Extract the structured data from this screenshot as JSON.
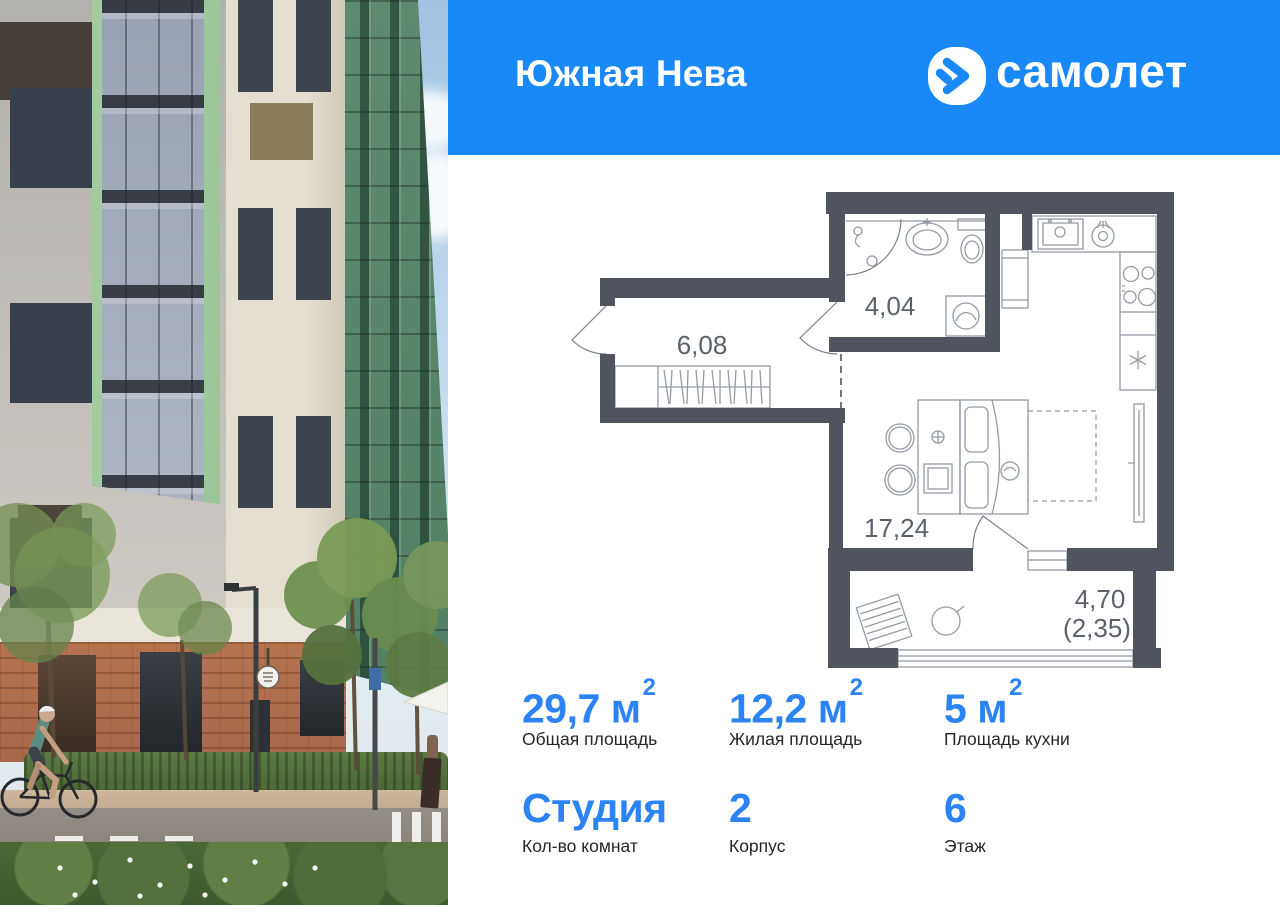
{
  "card": {
    "header": {
      "title": "Южная Нева",
      "brand": "самолет",
      "bg_color": "#1989FA"
    },
    "photo": {
      "description": "residential-building-street-view",
      "palette": {
        "sky": "#C6DCEF",
        "green_facade": "#A3CBA0",
        "brick": "#B5734F",
        "gray_facade": "#B3B1AD",
        "cream_facade": "#E4DFD1"
      }
    },
    "floor_plan": {
      "wall_color": "#50545E",
      "rooms": [
        {
          "id": "hallway",
          "area": "6,08"
        },
        {
          "id": "bathroom",
          "area": "4,04"
        },
        {
          "id": "living-room",
          "area": "17,24"
        },
        {
          "id": "balcony",
          "area": "4,70",
          "area_secondary": "(2,35)"
        }
      ]
    },
    "stats": {
      "accent_color": "#2B83F6",
      "areas": [
        {
          "value": "29,7",
          "unit": "м",
          "power": "2",
          "label": "Общая площадь"
        },
        {
          "value": "12,2",
          "unit": "м",
          "power": "2",
          "label": "Жилая площадь"
        },
        {
          "value": "5",
          "unit": "м",
          "power": "2",
          "label": "Площадь кухни"
        }
      ],
      "details": [
        {
          "value": "Студия",
          "label": "Кол-во комнат"
        },
        {
          "value": "2",
          "label": "Корпус"
        },
        {
          "value": "6",
          "label": "Этаж"
        }
      ]
    }
  }
}
